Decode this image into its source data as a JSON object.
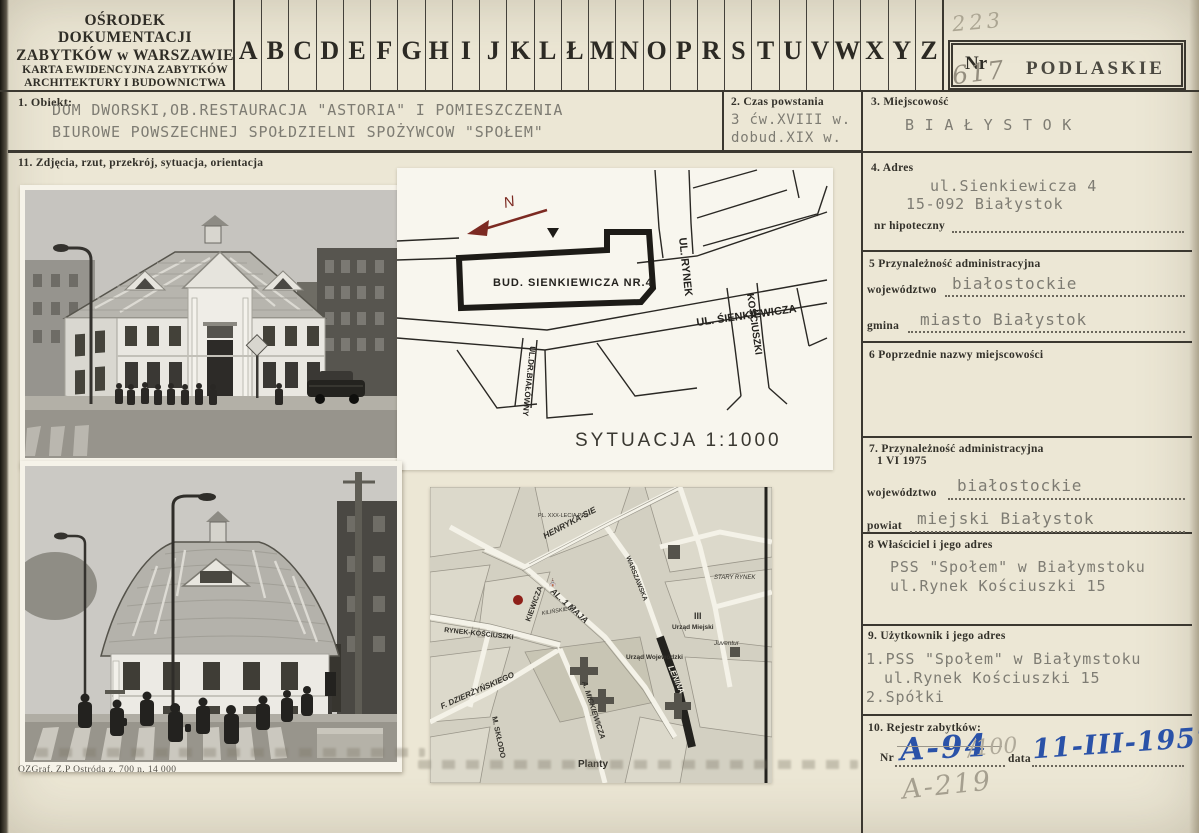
{
  "header": {
    "org_line1": "OŚRODEK DOKUMENTACJI",
    "org_line2": "ZABYTKÓW w WARSZAWIE",
    "org_line3": "KARTA EWIDENCYJNA ZABYTKÓW",
    "org_line4": "ARCHITEKTURY I BUDOWNICTWA",
    "letters": [
      "A",
      "B",
      "C",
      "D",
      "E",
      "F",
      "G",
      "H",
      "I",
      "J",
      "K",
      "L",
      "Ł",
      "M",
      "N",
      "O",
      "P",
      "R",
      "S",
      "T",
      "U",
      "V",
      "W",
      "X",
      "Y",
      "Z"
    ],
    "nr_label": "Nr",
    "nr_pencil_top": "223",
    "nr_pencil_bottom": "617",
    "region_stamp": "PODLASKIE"
  },
  "sections": {
    "s1": {
      "label": "1. Obiekt:",
      "line1": "DOM DWORSKI,OB.RESTAURACJA \"ASTORIA\" I POMIESZCZENIA",
      "line2": "BIUROWE POWSZECHNEJ SPOŁDZIELNI SPOŻYWCOW \"SPOŁEM\""
    },
    "s2": {
      "label": "2. Czas powstania",
      "line1": "3 ćw.XVIII w.",
      "line2": "dobud.XIX w."
    },
    "s3": {
      "label": "3. Miejscowość",
      "value": "B I A Ł Y S T O K"
    },
    "s4": {
      "label": "4. Adres",
      "line1": "ul.Sienkiewicza 4",
      "line2": "15-092 Białystok",
      "sub_label": "nr hipoteczny"
    },
    "s5": {
      "label": "5  Przynależność administracyjna",
      "field1": "województwo",
      "value1": "białostockie",
      "field2": "gmina",
      "value2": "miasto Białystok"
    },
    "s6": {
      "label": "6  Poprzednie nazwy miejscowości"
    },
    "s7": {
      "label": "7. Przynależność administracyjna",
      "label2": "1 VI 1975",
      "field1": "województwo",
      "value1": "białostockie",
      "field2": "powiat",
      "value2": "miejski Białystok"
    },
    "s8": {
      "label": "8  Właściciel i jego adres",
      "line1": "PSS \"Społem\" w Białymstoku",
      "line2": "ul.Rynek Kościuszki 15"
    },
    "s9": {
      "label": "9. Użytkownik i jego adres",
      "line1": "1.PSS \"Społem\" w Białymstoku",
      "line2": "ul.Rynek Kościuszki 15",
      "line3": "2.Spółki"
    },
    "s10": {
      "label": "10. Rejestr zabytków:",
      "nr_label": "Nr",
      "nr_value": "A-94",
      "nr_pencil": "/100",
      "date_label": "data",
      "date_value": "11-III-1957",
      "pencil_note": "A-219"
    },
    "s11": {
      "label": "11. Zdjęcia, rzut, przekrój, sytuacja, orientacja"
    }
  },
  "siteplan": {
    "north_label": "N",
    "building_label": "BUD. SIENKIEWICZA NR.4",
    "street_rynek": "UL. RYNEK",
    "street_sienkiewicza": "UL. ŚIENKIEWICZA",
    "street_kosciuszki": "KOŚCIUSZKI",
    "street_bialowny": "UL.DR.BIAŁÓWNY",
    "caption": "SYTUACJA 1:1000"
  },
  "citymap": {
    "henryka": "HENRYKA-SIE",
    "al1maja": "AL. 1 MAJA",
    "rynek_kosciuszki": "RYNEK-KOŚCIUSZKI",
    "kiewicza": "KIEWICZA",
    "warszawska": "WARSZAWSKA",
    "dzierzynskiego": "F. DZIERŻYŃSKIEGO",
    "mickiewicza": "A. MICKIEWICZA",
    "sklodowskiej": "M. SKŁODO",
    "lenina": "LENINA",
    "planty": "Planty",
    "urzad_wojewodzki": "Urząd Wojewódzki",
    "urzad_miejski": "Urząd Miejski",
    "stary_rynek": "STARY RYNEK",
    "pl_xxx": "PL. XXX-LECIA PRL",
    "juventur": "Juventur",
    "kilinskiego": "KILIŃSKIEGO",
    "roman_iii": "III"
  },
  "footer": {
    "imprint": "OZGraf. Z.P  Ostróda z. 700 n. 14 000"
  },
  "colors": {
    "paper": "#ece7d5",
    "ink": "#3b3830",
    "typewriter": "#7e7c73",
    "blue_ink": "#2a52a8",
    "pencil": "#a09a8b",
    "map_marker_red": "#8e2019"
  }
}
